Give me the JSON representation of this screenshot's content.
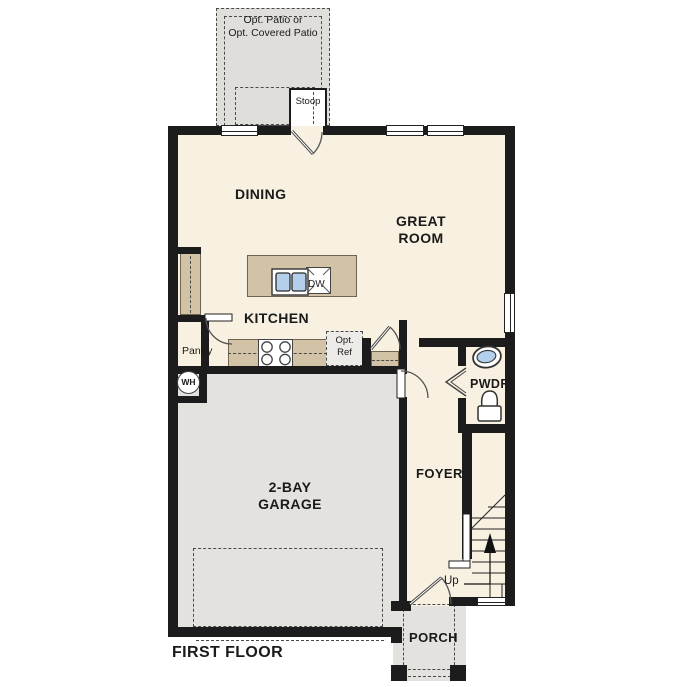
{
  "title": {
    "first_floor": "FIRST FLOOR"
  },
  "rooms": {
    "dining": "DINING",
    "great_room": {
      "l1": "GREAT",
      "l2": "ROOM"
    },
    "kitchen": "KITCHEN",
    "garage": {
      "l1": "2-BAY",
      "l2": "GARAGE"
    },
    "foyer": "FOYER",
    "powder": "PWDR",
    "pantry": "Pantry",
    "porch": "PORCH"
  },
  "features": {
    "stoop": "Stoop",
    "opt_patio": {
      "l1": "Opt. Patio or",
      "l2": "Opt. Covered Patio"
    },
    "opt_ref": {
      "l1": "Opt.",
      "l2": "Ref"
    },
    "dishwasher": "DW",
    "water_heater": "WH",
    "stairs_up": "Up"
  },
  "colors": {
    "wall": "#1c1c1c",
    "floor": "#f8f0e1",
    "concrete": "#e3e2de",
    "patio": "#dfdeda",
    "cabinet": "#d2c3a6",
    "cabinet-edge": "#6f6450",
    "sink": "#b3cfec",
    "line": "#3a3a3a",
    "ink": "#1a1a1a"
  }
}
